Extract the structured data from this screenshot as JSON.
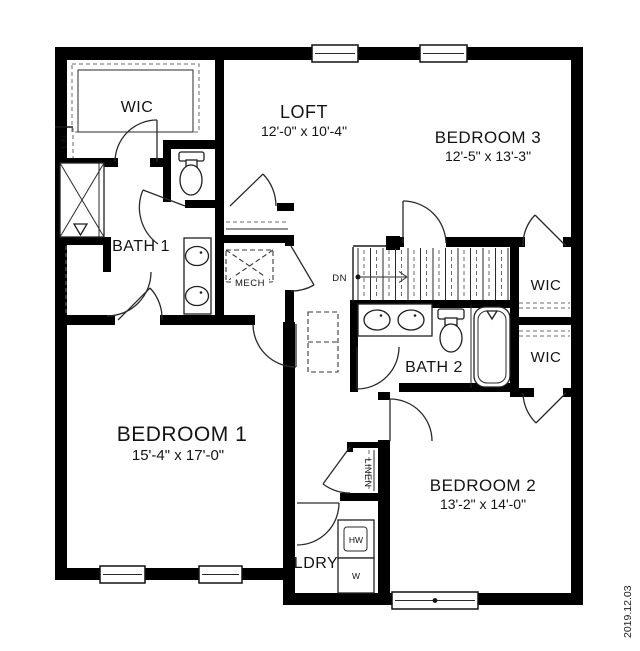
{
  "meta": {
    "date_stamp": "2019.12.03",
    "floor_name": "second-floor-plan"
  },
  "colors": {
    "walls": "#000000",
    "background": "#ffffff",
    "text": "#141414",
    "shelving_dash": "#6b6b6b"
  },
  "rooms": {
    "wic_upper_left": {
      "label": "WIC"
    },
    "loft": {
      "label": "LOFT",
      "dims": "12'-0\" x 10'-4\""
    },
    "bedroom3": {
      "label": "BEDROOM 3",
      "dims": "12'-5\" x 13'-3\""
    },
    "bath1": {
      "label": "BATH 1"
    },
    "mech": {
      "label": "MECH"
    },
    "wic_right_top": {
      "label": "WIC"
    },
    "wic_right_bottom": {
      "label": "WIC"
    },
    "bath2": {
      "label": "BATH 2"
    },
    "bedroom1": {
      "label": "BEDROOM 1",
      "dims": "15'-4\" x 17'-0\""
    },
    "bedroom2": {
      "label": "BEDROOM 2",
      "dims": "13'-2\" x 14'-0\""
    },
    "laundry": {
      "label": "LDRY"
    },
    "linen": {
      "label": "LINEN"
    },
    "lin_closet": {
      "label": "LIN."
    },
    "stairs": {
      "label": "DN"
    }
  },
  "appliances": {
    "laundry_unit_top": "HW",
    "laundry_unit_bottom": "W"
  }
}
